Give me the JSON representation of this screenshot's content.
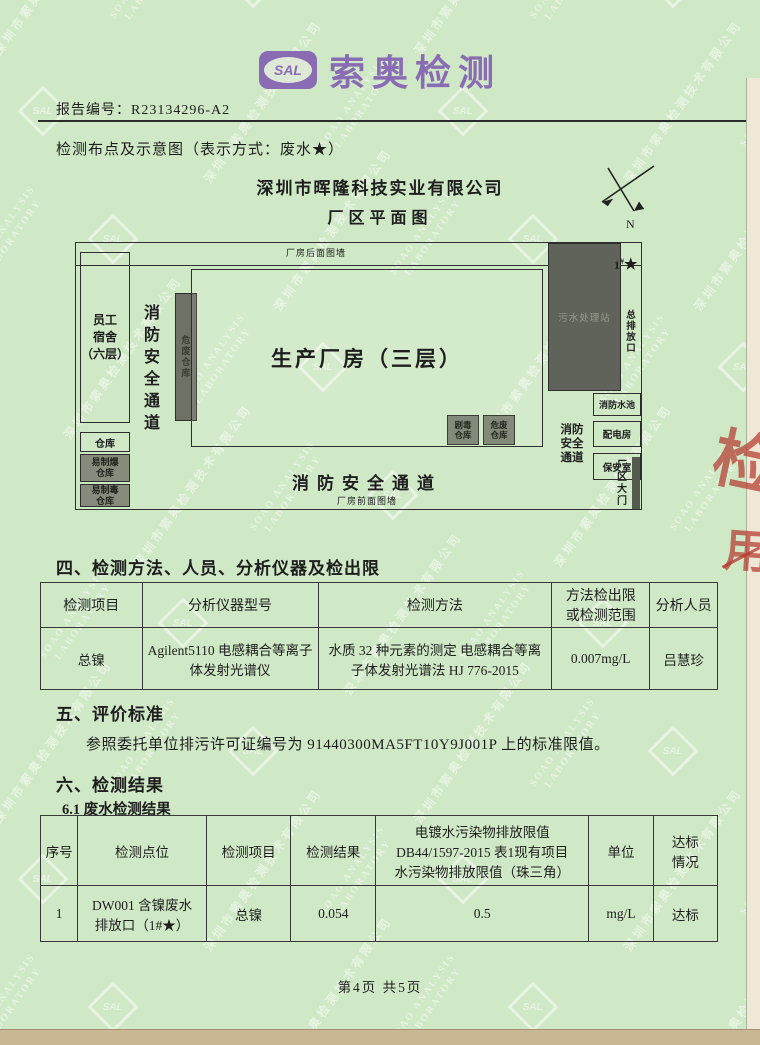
{
  "page": {
    "footer": "第4页 共5页",
    "bg_color": "#cfe8c6",
    "edge_right_color": "#efe8d6",
    "edge_bottom_color": "#c9b795"
  },
  "watermark": {
    "company": "深圳市索奥检测技术有限公司",
    "en_line1": "SOAO ANALYSIS",
    "en_line2": "LABORATORY",
    "logo": "SAL"
  },
  "header": {
    "logo_text": "SAL",
    "brand": "索奥检测",
    "brand_color": "#8a6cb4",
    "report_no_label": "报告编号：",
    "report_no": "R23134296-A2"
  },
  "intro": {
    "line": "检测布点及示意图（表示方式：废水★）"
  },
  "plan": {
    "company": "深圳市晖隆科技实业有限公司",
    "title": "厂区平面图",
    "north": "N",
    "labels": {
      "back_wall": "厂房后面图墙",
      "front_wall": "厂房前面图墙",
      "dorm": "员工\n宿舍\n（六层）",
      "fire_lane_left": "消\n防\n安\n全\n通\n道",
      "hazard_strip": "危\n废\n仓\n库",
      "main_building": "生产厂房（三层）",
      "warehouse": "仓库",
      "explosive_wh": "易制爆\n仓库",
      "toxic_wh": "易制毒\n仓库",
      "toxic_store": "剧毒\n仓库",
      "hazwaste_store": "危废\n仓库",
      "sewage": "污水处理站",
      "outfall": "总\n排\n放\n口",
      "point_no": "1",
      "point_sup": "#",
      "point_star": "★",
      "fire_pool": "消防水池",
      "power_room": "配电房",
      "guard_room": "保安室",
      "fire_lane_right": "消防\n安全\n通道",
      "fire_lane_bottom": "消防安全通道",
      "gate": "厂区\n大门"
    }
  },
  "section4": {
    "title": "四、检测方法、人员、分析仪器及检出限",
    "table": {
      "headers": [
        "检测项目",
        "分析仪器型号",
        "检测方法",
        "方法检出限\n或检测范围",
        "分析人员"
      ],
      "rows": [
        [
          "总镍",
          "Agilent5110 电感耦合等离子体发射光谱仪",
          "水质 32 种元素的测定 电感耦合等离子体发射光谱法 HJ 776-2015",
          "0.007mg/L",
          "吕慧珍"
        ]
      ]
    }
  },
  "section5": {
    "title": "五、评价标准",
    "body": "参照委托单位排污许可证编号为 91440300MA5FT10Y9J001P 上的标准限值。"
  },
  "section6": {
    "title": "六、检测结果",
    "subtitle": "6.1 废水检测结果",
    "table": {
      "headers": [
        "序号",
        "检测点位",
        "检测项目",
        "检测结果",
        "电镀水污染物排放限值\nDB44/1597-2015 表1现有项目\n水污染物排放限值（珠三角）",
        "单位",
        "达标\n情况"
      ],
      "rows": [
        [
          "1",
          "DW001 含镍废水\n排放口（1#★）",
          "总镍",
          "0.054",
          "0.5",
          "mg/L",
          "达标"
        ]
      ]
    }
  },
  "stamp": {
    "fragment1": "检",
    "fragment2": "用",
    "color": "#b5352c"
  }
}
